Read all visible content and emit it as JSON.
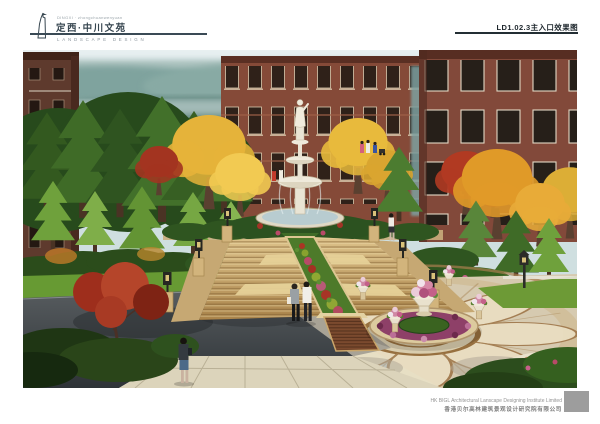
{
  "header": {
    "logo_tagline": "DINGXI · zhongchuanwenyuan",
    "project_title": "定西·中川文苑",
    "discipline_label": "LANDSCAPE DESIGN",
    "drawing_number": "LD1.02.3主入口效果图"
  },
  "footer": {
    "company_en": "HK BIGL Architectural Lanscape Designing Institute Limited",
    "company_cn": "香港贝尔高林建筑景观设计研究院有限公司"
  },
  "palette": {
    "header_ink": "#36454f",
    "rule_dark": "#232e34",
    "brick_red": "#8a4d3c",
    "stone_tan": "#d3b67e",
    "foliage_green": "#3f6b27",
    "foliage_gold": "#e5b33a",
    "maple_red": "#a33420",
    "flower_magenta": "#8e4068",
    "plaza_cream": "#e3d8ba",
    "asphalt": "#3c4144",
    "haze_teal": "#8fb0ac"
  }
}
